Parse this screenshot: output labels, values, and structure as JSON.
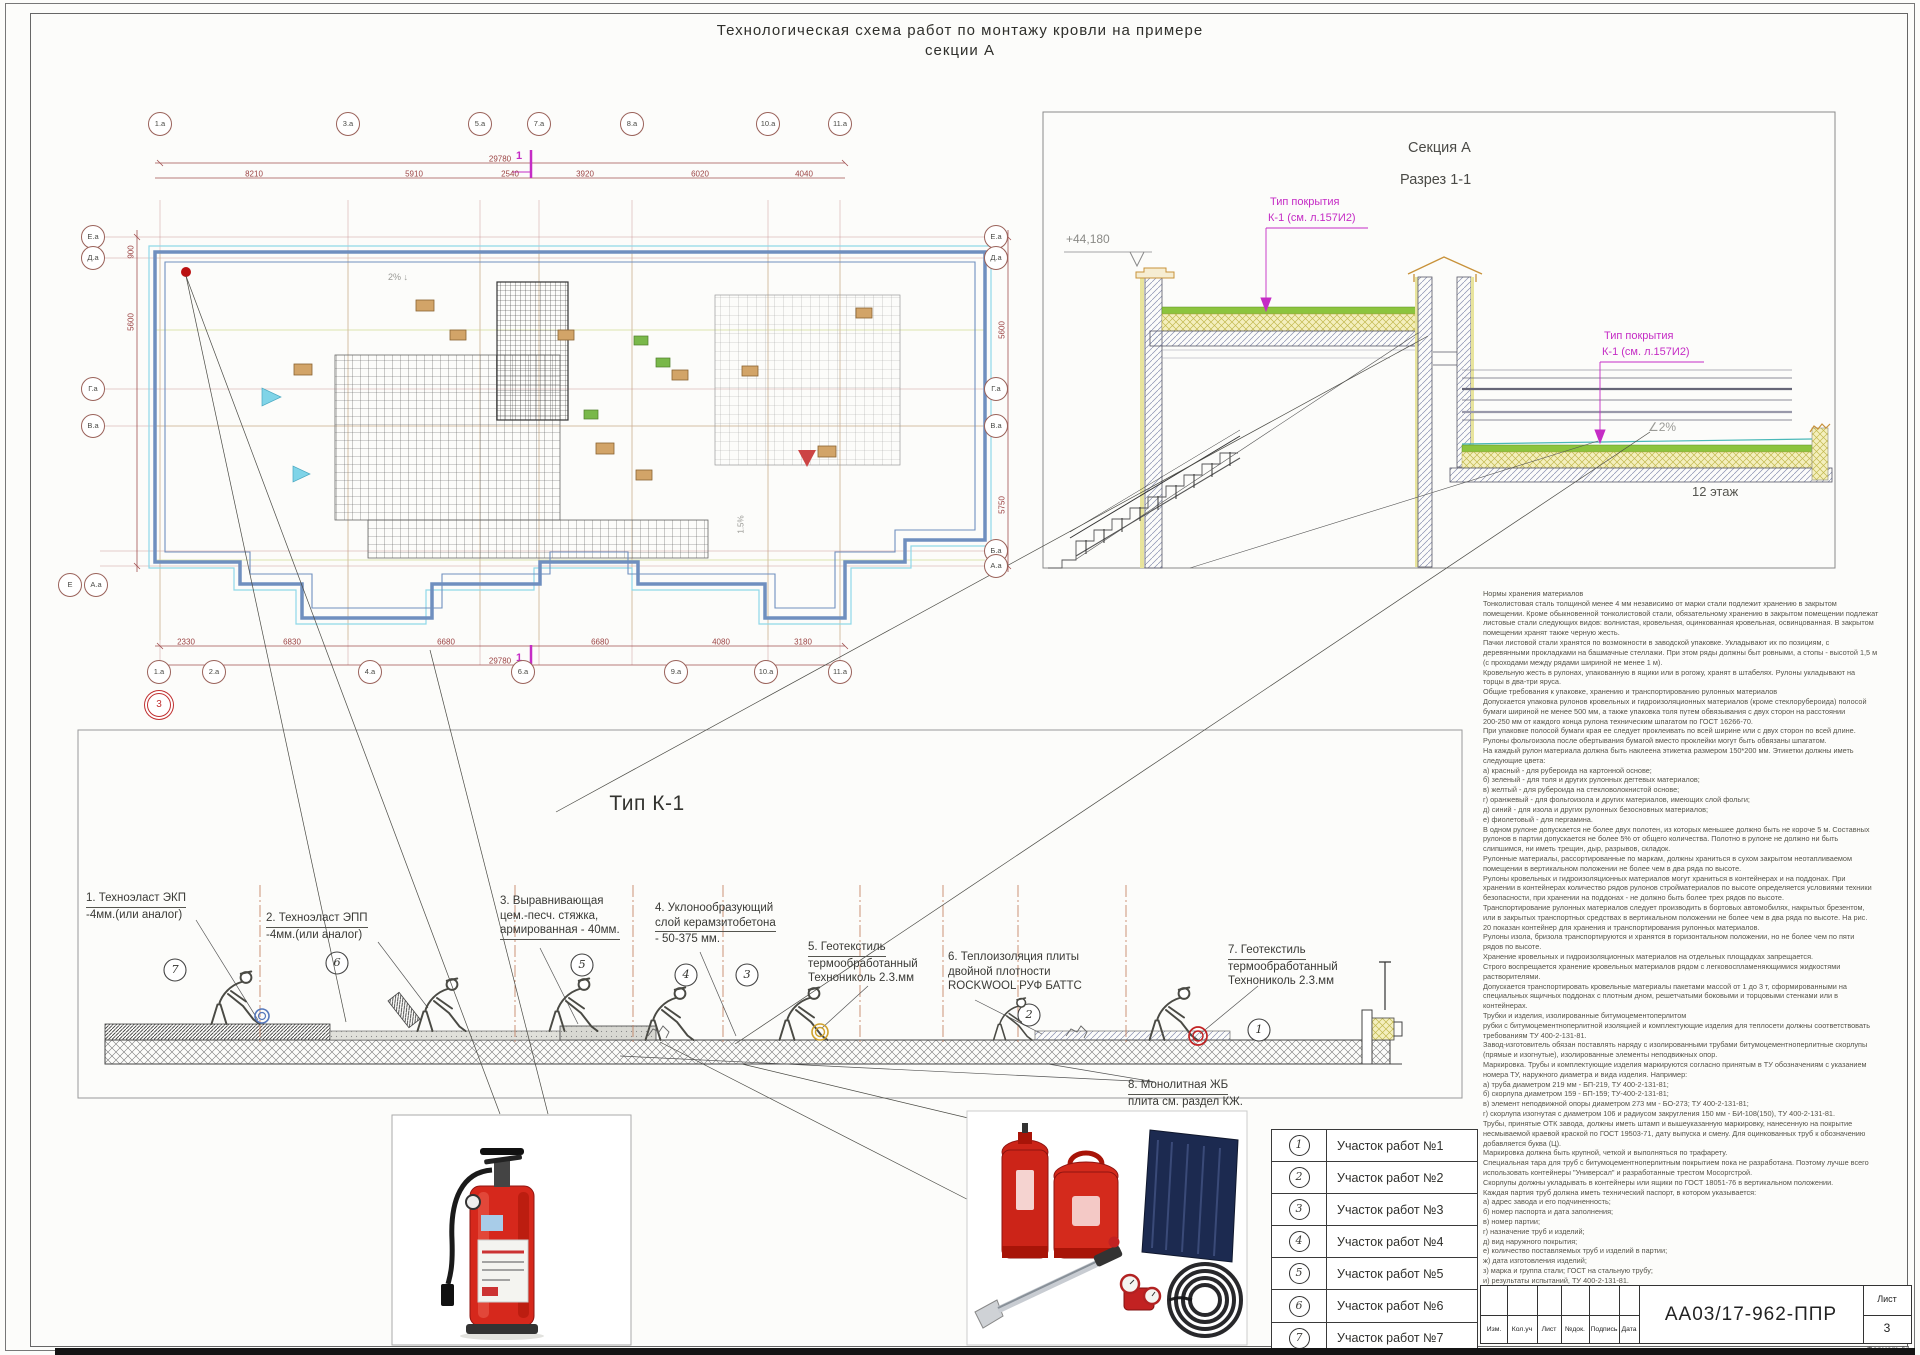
{
  "doc": {
    "title_line1": "Технологическая схема работ по монтажу кровли на примере",
    "title_line2": "секции А"
  },
  "plan": {
    "axes_top": [
      "1.а",
      "3.а",
      "5.а",
      "7.а",
      "8.а",
      "10.а",
      "11.а"
    ],
    "axes_bottom": [
      "1.а",
      "2.а",
      "4.а",
      "6.а",
      "9.а",
      "10.а",
      "11.а"
    ],
    "axes_left": [
      "Е.а",
      "Д.а",
      "Г.а",
      "В.а"
    ],
    "axes_left_corner": [
      "Е",
      "А.а"
    ],
    "axes_right": [
      "Е.а",
      "Д.а",
      "Г.а",
      "В.а",
      "Б.а",
      "А.а"
    ],
    "detail_mark": "3",
    "dim_total_top": "29780",
    "dims_top": [
      "8210",
      "5910",
      "2540",
      "3920",
      "6020",
      "4040"
    ],
    "dim_total_bottom": "29780",
    "dims_bottom": [
      "2330",
      "6830",
      "6680",
      "6680",
      "4080",
      "3180"
    ],
    "dims_left": [
      "900",
      "5600"
    ],
    "dims_right": [
      "5600",
      "5750"
    ],
    "slope_down": "2%",
    "slope_right": "1.5%",
    "cut_label": "1"
  },
  "section": {
    "name": "Секция А",
    "view": "Разрез 1-1",
    "elevation": "+44,180",
    "cover_note_line1": "Тип покрытия",
    "cover_note_line2": "К-1 (см. л.157И2)",
    "slope": "∠2%",
    "floor_label": "12 этаж"
  },
  "detail": {
    "title": "Тип К-1",
    "area_marks": [
      "7",
      "6",
      "5",
      "4",
      "3",
      "2",
      "1"
    ],
    "annotations": [
      [
        "1. Техноэласт ЭКП",
        "-4мм.(или аналог)"
      ],
      [
        "3. Выравнивающая",
        "цем.-песч. стяжка,",
        "армированная - 40мм."
      ],
      [
        "2. Техноэласт ЭПП",
        "-4мм.(или аналог)"
      ],
      [
        "4. Уклонообразующий",
        "слой керамзитобетона",
        "- 50-375 мм."
      ],
      [
        "5. Геотекстиль",
        "термообработанный",
        "Технониколь 2.3.мм"
      ],
      [
        "6. Теплоизоляция плиты",
        "двойной плотности",
        "ROCKWOOL РУФ БАТТС"
      ],
      [
        "7. Геотекстиль",
        "термообработанный",
        "Технониколь 2.3.мм"
      ],
      [
        "8. Монолитная ЖБ",
        "плита см. раздел КЖ."
      ]
    ]
  },
  "notes": {
    "lines": [
      "Нормы хранения материалов",
      "Тонколистовая сталь толщиной менее 4 мм независимо от марки стали подлежит хранению в закрытом",
      "помещении. Кроме обыкновенной тонколистовой стали, обязательному хранению в закрытом помещении подлежат",
      "листовые стали следующих видов: волнистая, кровельная, оцинкованная кровельная, освинцованная. В закрытом",
      "помещении хранят также черную жесть.",
      "Пачки листовой стали хранятся по возможности в заводской упаковке. Укладывают их по позициям, с",
      "деревянными прокладками на башмачные стеллажи. При этом ряды должны быт ровными, а стопы - высотой 1,5 м",
      "(с проходами между рядами шириной не менее 1 м).",
      "Кровельную жесть в рулонах, упакованную в ящики или в рогожу, хранят в штабелях. Рулоны укладывают на",
      "торцы в два-три яруса.",
      "Общие требования к упаковке, хранению и транспортированию рулонных материалов",
      "Допускается упаковка рулонов кровельных и гидроизоляционных материалов (кроме стеклорубероида) полосой",
      "бумаги шириной не менее 500 мм, а также упаковка толя путем обвязывания с двух сторон на расстоянии",
      "200-250 мм от каждого конца рулона техническим шпагатом по ГОСТ 16266-70.",
      "При упаковке полосой бумаги края ее следует проклеивать по всей ширине или с двух сторон по всей длине.",
      "Рулоны фольгоизола после обертывания бумагой вместо проклейки могут быть обвязаны шпагатом.",
      "На каждый рулон материала должна быть наклеена этикетка размером 150*200 мм. Этикетки должны иметь",
      "следующие цвета:",
      "а) красный - для рубероида на картонной основе;",
      "б) зеленый - для толя и других рулонных дегтевых материалов;",
      "в) желтый - для рубероида на стекловолокнистой основе;",
      "г) оранжевый - для фольгоизола и других материалов, имеющих слой фольги;",
      "д) синий - для изола и других рулонных безосновных материалов;",
      "е) фиолетовый - для пергамина.",
      "В одном рулоне допускается не более двух полотен, из которых меньшее должно быть не короче 5 м. Составных",
      "рулонов в партии допускается не более 5% от общего количества. Полотно в рулоне не должно ни быть",
      "слипшимся, ни иметь трещин, дыр, разрывов, складок.",
      "Рулонные материалы, рассортированные по маркам, должны храниться в сухом закрытом неотапливаемом",
      "помещении в вертикальном положении не более чем в два ряда по высоте.",
      "Рулоны кровельных и гидроизоляционных материалов могут храниться в контейнерах и на поддонах. При",
      "хранении в контейнерах количество рядов рулонов стройматериалов по высоте определяется условиями техники",
      "безопасности, при хранении на поддонах - не должно быть более трех рядов по высоте.",
      "Транспортирование рулонных материалов следует производить в бортовых автомобилях, накрытых брезентом,",
      "или в закрытых транспортных средствах в вертикальном положении не более чем в два ряда по высоте. На рис.",
      "20 показан контейнер для хранения и транспортирования рулонных материалов.",
      "Рулоны изола, бризола транспортируются и хранятся в горизонтальном положении, но не более чем по пяти",
      "рядов по высоте.",
      "Хранение кровельных и гидроизоляционных материалов на отдельных площадках запрещается.",
      "Строго воспрещается хранение кровельных материалов рядом с легковоспламеняющимися жидкостями",
      "растворителями.",
      "Допускается транспортировать кровельные материалы пакетами массой от 1 до 3 т, сформированными на",
      "специальных ящичных поддонах с плотным дном, решетчатыми боковыми и торцовыми стенками или в",
      "контейнерах.",
      "Трубки и изделия, изолированные битумоцементоперлитом",
      "рубки с битумоцементноперлитной изоляцией и комплектующие изделия для теплосети должны соответствовать",
      "требованиям ТУ 400-2-131-81.",
      "Завод-изготовитель обязан поставлять наряду с изолированными трубами битумоцементноперлитные скорлупы",
      "(прямые и изогнутые), изолированные элементы неподвижных опор.",
      "Маркировка. Трубы и комплектующие изделия маркируются согласно принятым в ТУ обозначениям с указанием",
      "номера ТУ, наружного диаметра и вида изделия. Например:",
      "а) труба диаметром 219 мм - БП-219, ТУ 400-2-131-81;",
      "б) скорлупа диаметром 159 - БП-159; ТУ-400-2-131-81;",
      "в) элемент неподвижной опоры диаметром 273 мм - БО-273; ТУ 400-2-131-81;",
      "г) скорлупа изогнутая с диаметром 106 и радиусом закругления 150 мм - БИ-108(150), ТУ 400-2-131-81.",
      "Трубы, принятые ОТК завода, должны иметь штамп и вышеуказанную маркировку, нанесенную на покрытие",
      "несмываемой краевой краской по ГОСТ 19503-71, дату выпуска и смену. Для оцинкованных труб к обозначению",
      "добавляется буква (Ц).",
      "Маркировка должна быть крупной, четкой и выполняться по трафарету.",
      "Специальная тара для труб с битумоцементноперлитным покрытием пока не разработана. Поэтому лучше всего",
      "использовать контейнеры \"Универсал\" и разработанные трестом Мосоргстрой.",
      "Скорлупы должны укладывать в контейнеры или ящики по ГОСТ 18051-76 в вертикальном положении.",
      "Каждая партия труб должна иметь технический паспорт, в котором указывается:",
      "а) адрес завода и его подчиненность;",
      "б) номер паспорта и дата заполнения;",
      "в) номер партии;",
      "г) назначение труб и изделий;",
      "д) вид наружного покрытия;",
      "е) количество поставляемых труб и изделий в партии;",
      "ж) дата изготовления изделий;",
      "з) марка и группа стали; ГОСТ на стальную трубу;",
      "и) результаты испытаний, ТУ 400-2-131-81."
    ]
  },
  "legend": {
    "rows": [
      {
        "num": "1",
        "label": "Участок работ №1"
      },
      {
        "num": "2",
        "label": "Участок работ №2"
      },
      {
        "num": "3",
        "label": "Участок работ №3"
      },
      {
        "num": "4",
        "label": "Участок работ №4"
      },
      {
        "num": "5",
        "label": "Участок работ №5"
      },
      {
        "num": "6",
        "label": "Участок работ №6"
      },
      {
        "num": "7",
        "label": "Участок работ №7"
      }
    ]
  },
  "titleblock": {
    "doc_number": "АА03/17-962-ППР",
    "sheet_label": "Лист",
    "sheet_number": "3",
    "cols": [
      "Изм.",
      "Кол.уч",
      "Лист",
      "№док.",
      "Подпись",
      "Дата"
    ],
    "format_label": "Формат А1"
  }
}
